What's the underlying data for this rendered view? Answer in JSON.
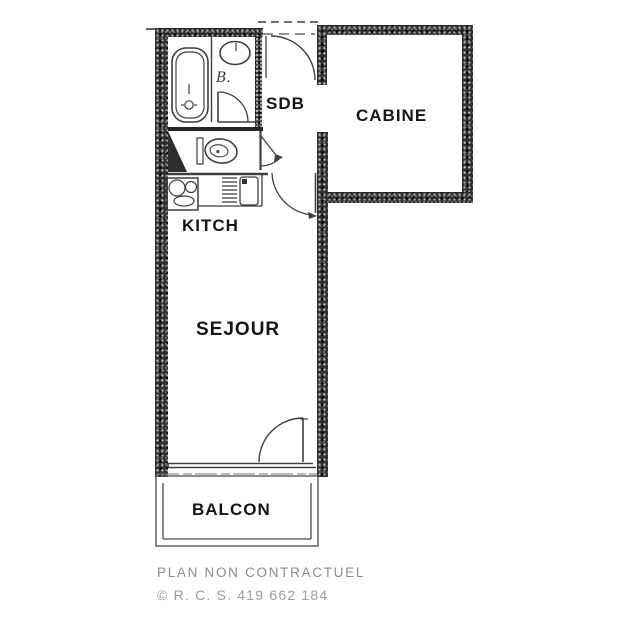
{
  "plan": {
    "title": "studio-apartment-floor-plan",
    "rooms": {
      "sdb": "SDB",
      "cabine": "CABINE",
      "kitch": "KITCH",
      "sejour": "SEJOUR",
      "balcon": "BALCON",
      "bath_annotation": "B."
    },
    "fixtures": [
      "bathtub",
      "washbasin",
      "toilet",
      "stove",
      "kitchen-sink",
      "dish-drainer"
    ],
    "doors": [
      "entry-door",
      "bathroom-door",
      "wc-door",
      "kitchen-door",
      "balcony-door"
    ],
    "window": "sejour-balcony-window",
    "footer": {
      "disclaimer": "PLAN NON CONTRACTUEL",
      "registration": "© R. C. S. 419 662 184"
    },
    "colors": {
      "wall": "#30302d",
      "line": "#3f3f3f",
      "label": "#151515",
      "footer_disclaimer": "#8d8d8d",
      "footer_registration": "#9d9d9d",
      "background": "#ffffff"
    }
  }
}
